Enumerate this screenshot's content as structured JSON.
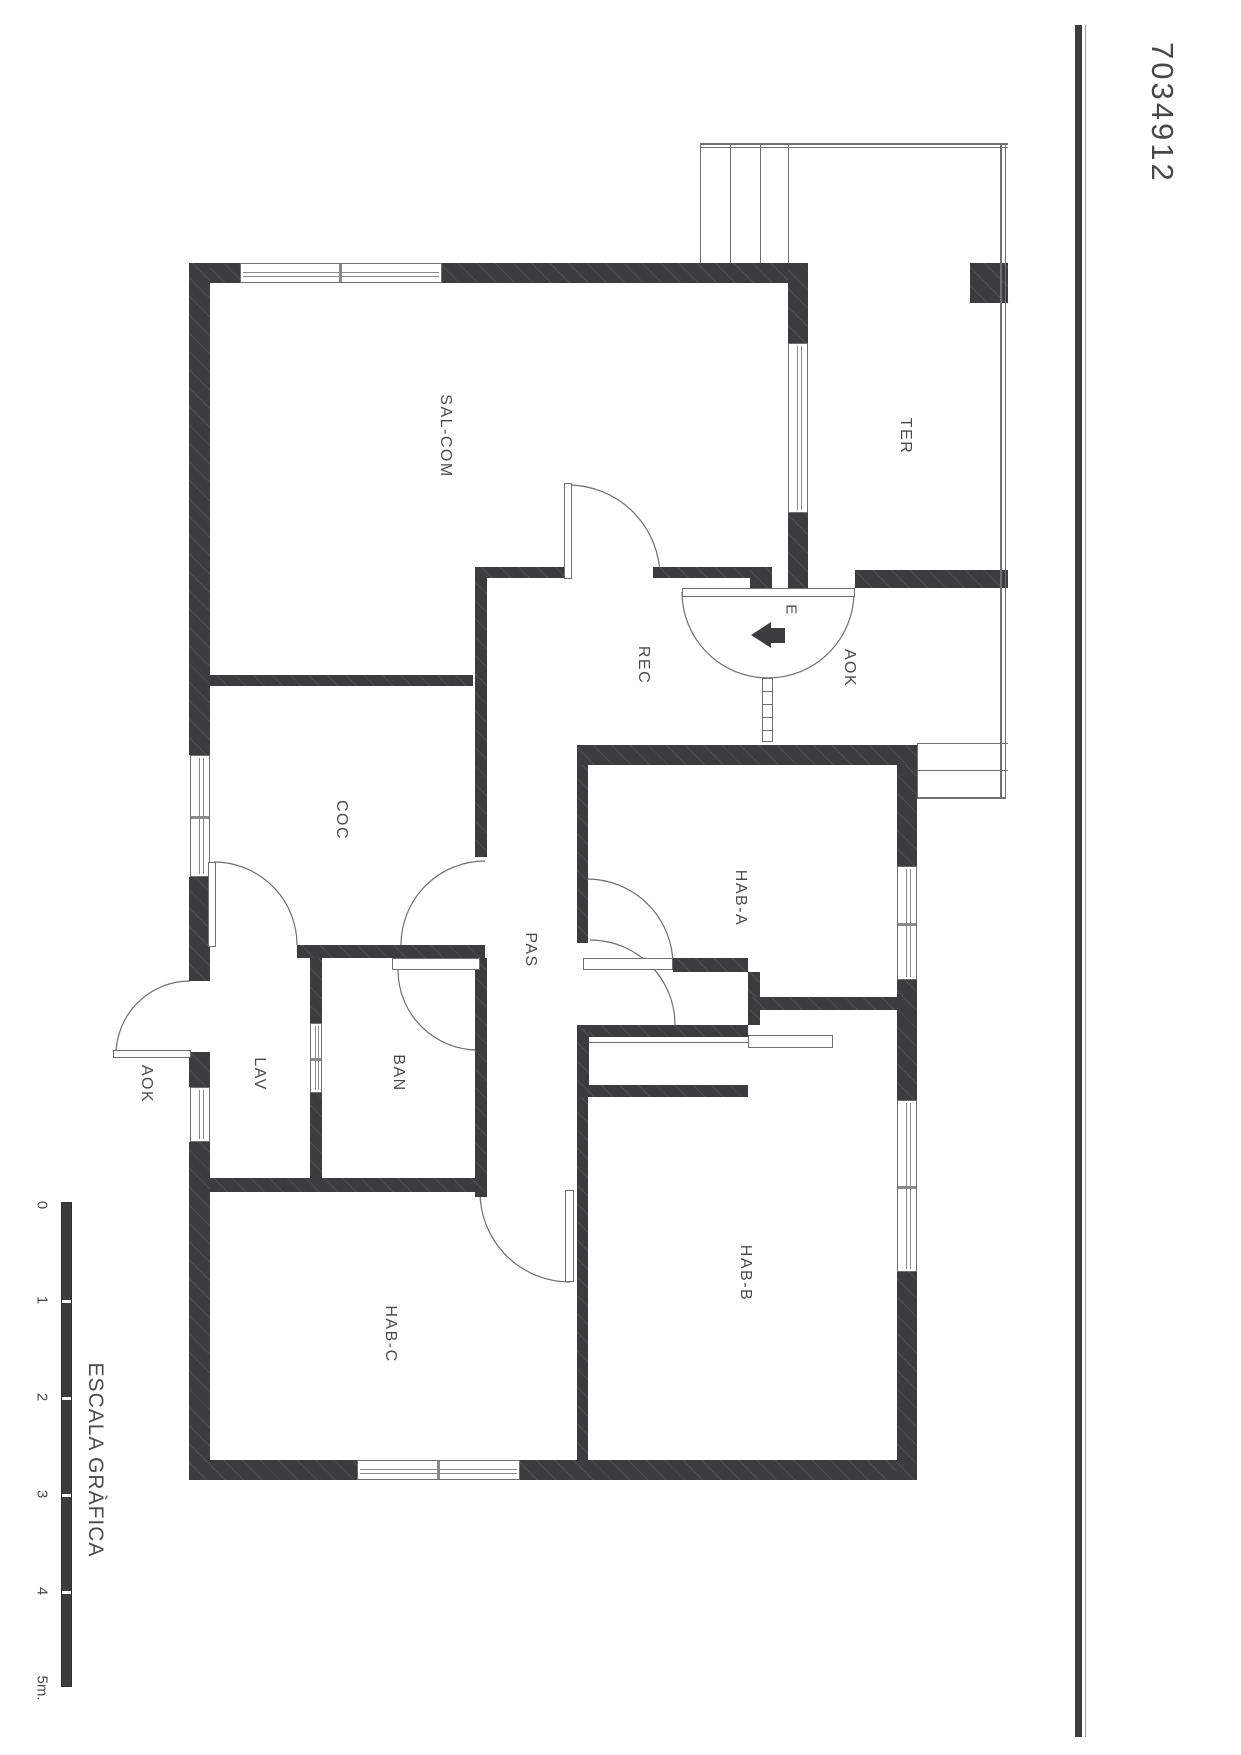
{
  "header": {
    "code": "7034912"
  },
  "scale": {
    "title": "ESCALA GRÀFICA",
    "bar": {
      "x": 61,
      "y": 1202,
      "w": 11,
      "h": 485
    },
    "separators_y": [
      1299,
      1396,
      1493,
      1590
    ],
    "ticks": [
      {
        "label": "0",
        "y": 1205
      },
      {
        "label": "1",
        "y": 1300
      },
      {
        "label": "2",
        "y": 1397
      },
      {
        "label": "3",
        "y": 1494
      },
      {
        "label": "4",
        "y": 1591
      },
      {
        "label": "5m.",
        "y": 1688
      }
    ],
    "label_x": 42,
    "title_x": 95,
    "title_y": 1460
  },
  "rooms": [
    {
      "id": "sal-com",
      "label": "SAL-COM",
      "x": 445,
      "y": 436,
      "fs": 16
    },
    {
      "id": "ter",
      "label": "TER",
      "x": 905,
      "y": 436,
      "fs": 16
    },
    {
      "id": "rec",
      "label": "REC",
      "x": 643,
      "y": 665,
      "fs": 16
    },
    {
      "id": "aok-entry",
      "label": "AOK",
      "x": 849,
      "y": 668,
      "fs": 16
    },
    {
      "id": "entrance",
      "label": "E",
      "x": 791,
      "y": 610,
      "fs": 15
    },
    {
      "id": "coc",
      "label": "COC",
      "x": 341,
      "y": 820,
      "fs": 16
    },
    {
      "id": "hab-a",
      "label": "HAB-A",
      "x": 740,
      "y": 898,
      "fs": 16
    },
    {
      "id": "pas",
      "label": "PAS",
      "x": 530,
      "y": 950,
      "fs": 16
    },
    {
      "id": "lav",
      "label": "LAV",
      "x": 259,
      "y": 1074,
      "fs": 16
    },
    {
      "id": "ban",
      "label": "BAN",
      "x": 398,
      "y": 1073,
      "fs": 16
    },
    {
      "id": "aok-side",
      "label": "AOK",
      "x": 146,
      "y": 1084,
      "fs": 16
    },
    {
      "id": "hab-b",
      "label": "HAB-B",
      "x": 745,
      "y": 1273,
      "fs": 16
    },
    {
      "id": "hab-c",
      "label": "HAB-C",
      "x": 390,
      "y": 1334,
      "fs": 16
    }
  ],
  "plan": {
    "walls": [
      [
        189,
        263,
        51,
        20
      ],
      [
        442,
        263,
        366,
        20
      ],
      [
        189,
        263,
        21,
        492
      ],
      [
        189,
        877,
        21,
        104
      ],
      [
        189,
        1052,
        21,
        35
      ],
      [
        189,
        1142,
        21,
        338
      ],
      [
        189,
        1460,
        168,
        20
      ],
      [
        520,
        1460,
        397,
        20
      ],
      [
        897,
        745,
        20,
        121
      ],
      [
        897,
        980,
        20,
        120
      ],
      [
        897,
        1272,
        20,
        208
      ],
      [
        788,
        263,
        20,
        80
      ],
      [
        788,
        513,
        20,
        75
      ],
      [
        210,
        675,
        263,
        11
      ],
      [
        475,
        567,
        12,
        290
      ],
      [
        475,
        567,
        90,
        11
      ],
      [
        653,
        567,
        99,
        11
      ],
      [
        750,
        567,
        22,
        21
      ],
      [
        855,
        570,
        153,
        18
      ],
      [
        577,
        745,
        340,
        20
      ],
      [
        577,
        765,
        11,
        178
      ],
      [
        673,
        958,
        75,
        14
      ],
      [
        748,
        972,
        12,
        53
      ],
      [
        748,
        997,
        150,
        13
      ],
      [
        577,
        1025,
        171,
        12
      ],
      [
        577,
        1025,
        12,
        72
      ],
      [
        577,
        1085,
        171,
        12
      ],
      [
        577,
        1097,
        11,
        363
      ],
      [
        475,
        958,
        12,
        239
      ],
      [
        310,
        958,
        12,
        65
      ],
      [
        310,
        1093,
        12,
        85
      ],
      [
        210,
        1178,
        277,
        14
      ],
      [
        297,
        945,
        188,
        13
      ],
      [
        970,
        263,
        38,
        40
      ]
    ],
    "windows": [
      {
        "r": [
          240,
          263,
          202,
          20
        ],
        "o": "h",
        "m": 0.49
      },
      {
        "r": [
          357,
          1460,
          163,
          20
        ],
        "o": "h",
        "m": 0.49
      },
      {
        "r": [
          788,
          343,
          20,
          170
        ],
        "o": "v",
        "m": -1
      },
      {
        "r": [
          190,
          755,
          20,
          122
        ],
        "o": "v",
        "m": 0.5
      },
      {
        "r": [
          190,
          1087,
          20,
          55
        ],
        "o": "v",
        "m": -1
      },
      {
        "r": [
          897,
          866,
          20,
          114
        ],
        "o": "v",
        "m": 0.5
      },
      {
        "r": [
          897,
          1100,
          20,
          172
        ],
        "o": "v",
        "m": 0.5
      },
      {
        "r": [
          310,
          1023,
          12,
          70
        ],
        "o": "v",
        "m": 0.5
      }
    ],
    "frames": [
      [
        392,
        958,
        88,
        12
      ],
      [
        583,
        958,
        90,
        12
      ],
      [
        748,
        1035,
        85,
        13
      ],
      [
        682,
        588,
        173,
        9
      ],
      [
        564,
        483,
        8,
        96
      ],
      [
        565,
        1190,
        9,
        92
      ],
      [
        208,
        862,
        8,
        85
      ],
      [
        113,
        1050,
        78,
        8
      ],
      [
        762,
        678,
        11,
        64
      ]
    ],
    "lines": [
      [
        700,
        143,
        308,
        2
      ],
      [
        700,
        147,
        308,
        1
      ],
      [
        1000,
        143,
        2,
        654
      ],
      [
        1005,
        143,
        1,
        654
      ],
      [
        700,
        143,
        1,
        120
      ],
      [
        730,
        143,
        1,
        120
      ],
      [
        760,
        143,
        1,
        120
      ],
      [
        788,
        143,
        1,
        120
      ],
      [
        917,
        743,
        91,
        1
      ],
      [
        917,
        770,
        91,
        1
      ],
      [
        917,
        797,
        89,
        2
      ],
      [
        917,
        743,
        1,
        56
      ],
      [
        589,
        1042,
        159,
        1
      ],
      [
        763,
        691,
        9,
        1
      ],
      [
        763,
        704,
        9,
        1
      ],
      [
        763,
        717,
        9,
        1
      ],
      [
        763,
        730,
        9,
        1
      ]
    ],
    "arcs": [
      "M 568 485 A 92 92 0 0 1 660 577",
      "M 682 592 A 86 86 0 0 0 854 592",
      "M 401 945 A 84 84 0 0 1 485 861",
      "M 214 862 A 83 83 0 0 1 297 945",
      "M 398 970 A 80 80 0 0 0 478 1050",
      "M 587 879 A 86 86 0 0 1 673 965",
      "M 590 940 A 85 85 0 0 1 675 1025",
      "M 480 1192 A 90 90 0 0 0 570 1282",
      "M 116 1055 A 74 74 0 0 1 190 981",
      "M 970 263 L 1008 303"
    ],
    "border_line": {
      "x": 1075,
      "y": 25,
      "w": 7,
      "h": 1712
    },
    "border_hair": {
      "x": 1085,
      "y": 25,
      "w": 1,
      "h": 1712
    },
    "code_pos": {
      "x": 1162,
      "y": 42
    },
    "e_arrow": {
      "tip_x": 751,
      "y": 622,
      "tail": [
        771,
        628,
        14,
        15
      ]
    }
  }
}
